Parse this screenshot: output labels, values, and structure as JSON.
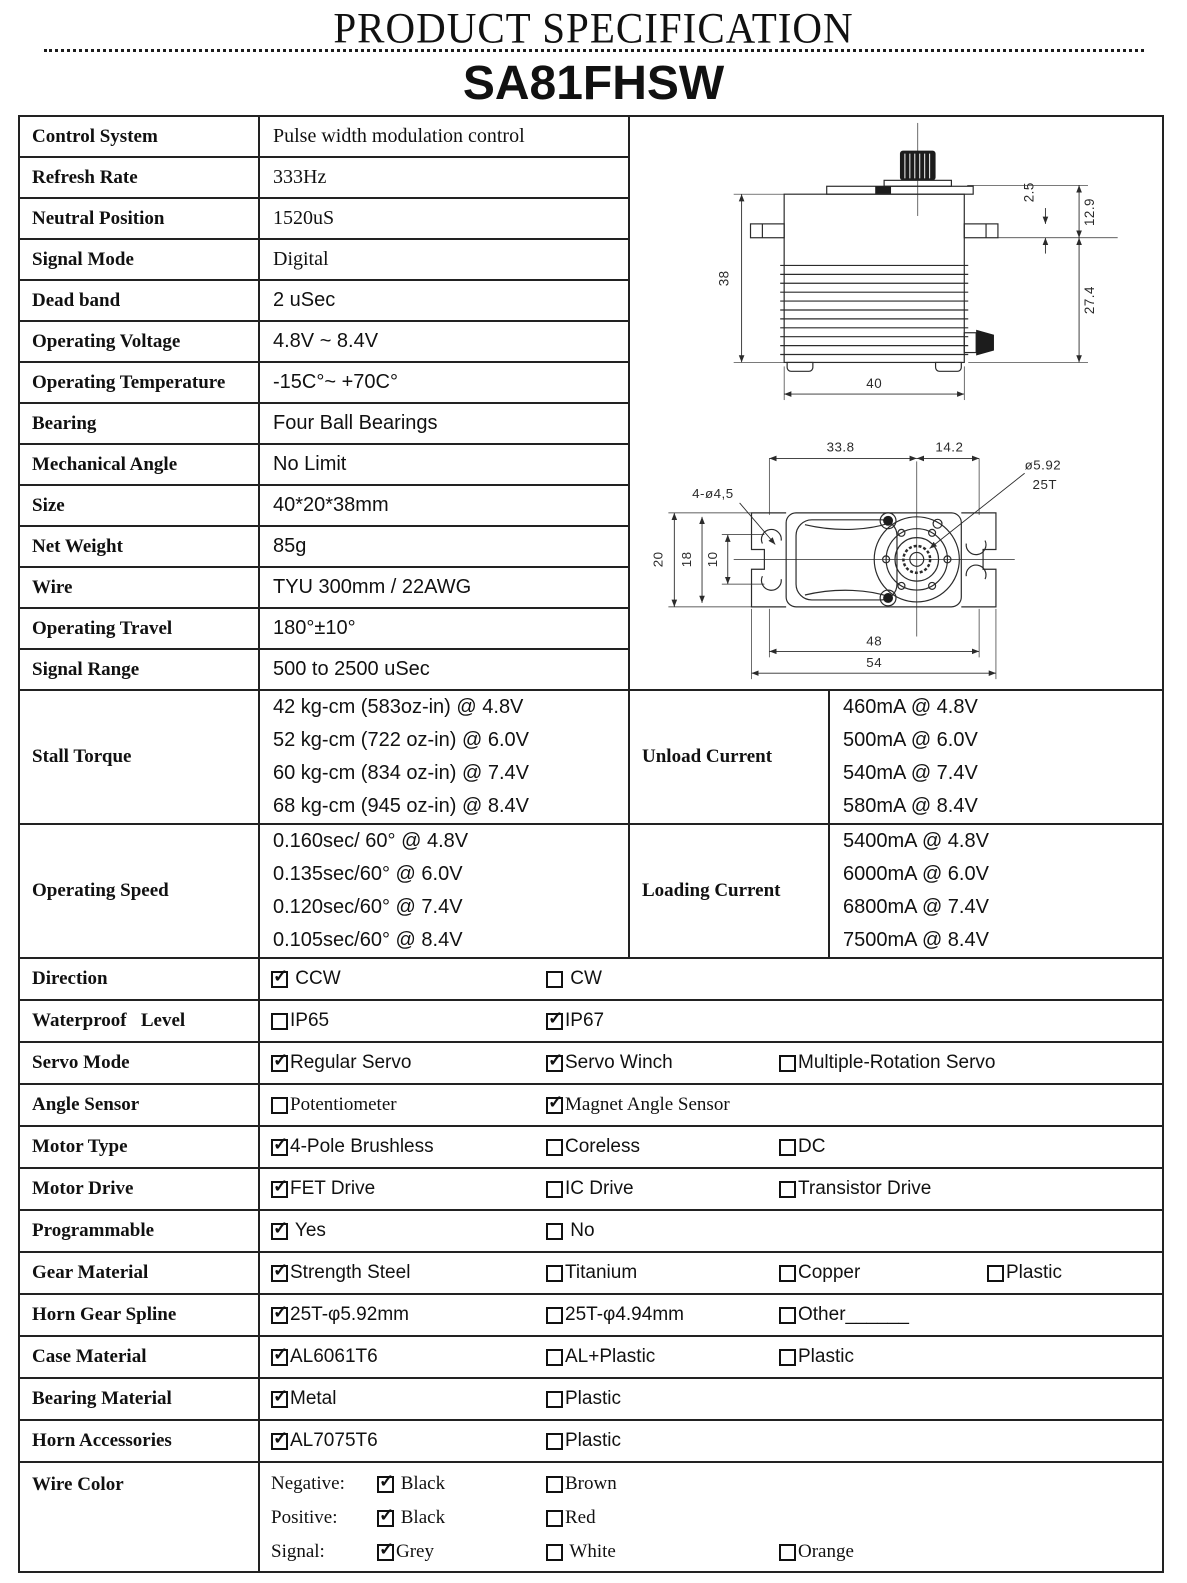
{
  "page": {
    "title": "PRODUCT SPECIFICATION",
    "model": "SA81FHSW"
  },
  "specs": [
    {
      "label": "Control System",
      "value": "Pulse width modulation control"
    },
    {
      "label": "Refresh Rate",
      "value": "333Hz"
    },
    {
      "label": "Neutral Position",
      "value": "1520uS"
    },
    {
      "label": "Signal Mode",
      "value": "Digital"
    },
    {
      "label": "Dead band",
      "value": "2 uSec"
    },
    {
      "label": "Operating Voltage",
      "value": "4.8V ~ 8.4V"
    },
    {
      "label": "Operating Temperature",
      "value": "-15C°~ +70C°"
    },
    {
      "label": "Bearing",
      "value": "Four Ball Bearings"
    },
    {
      "label": "Mechanical Angle",
      "value": "No Limit"
    },
    {
      "label": "Size",
      "value": "40*20*38mm"
    },
    {
      "label": "Net Weight",
      "value": "85g"
    },
    {
      "label": "Wire",
      "value": "TYU 300mm / 22AWG"
    },
    {
      "label": "Operating Travel",
      "value": "180°±10°"
    },
    {
      "label": "Signal Range",
      "value": "500 to 2500 uSec"
    }
  ],
  "torque_rows": [
    {
      "label": "Stall Torque",
      "values": [
        "42 kg-cm (583oz-in) @ 4.8V",
        "52 kg-cm (722 oz-in) @ 6.0V",
        "60 kg-cm (834 oz-in) @ 7.4V",
        "68 kg-cm (945 oz-in) @ 8.4V"
      ],
      "label2": "Unload Current",
      "values2": [
        "460mA @ 4.8V",
        "500mA @ 6.0V",
        "540mA @ 7.4V",
        "580mA @ 8.4V"
      ]
    },
    {
      "label": "Operating Speed",
      "values": [
        "0.160sec/ 60° @ 4.8V",
        "0.135sec/60° @ 6.0V",
        "0.120sec/60° @ 7.4V",
        "0.105sec/60° @ 8.4V"
      ],
      "label2": "Loading Current",
      "values2": [
        "5400mA @ 4.8V",
        "6000mA @ 6.0V",
        "6800mA @ 7.4V",
        "7500mA @ 8.4V"
      ]
    }
  ],
  "option_rows": [
    {
      "label": "Direction",
      "options": [
        {
          "label": " CCW",
          "checked": true
        },
        {
          "label": " CW",
          "checked": false
        }
      ]
    },
    {
      "label": "Waterproof   Level",
      "options": [
        {
          "label": "IP65",
          "checked": false
        },
        {
          "label": "IP67",
          "checked": true
        }
      ]
    },
    {
      "label": "Servo Mode",
      "options": [
        {
          "label": "Regular Servo",
          "checked": true
        },
        {
          "label": "Servo Winch",
          "checked": true
        },
        {
          "label": "Multiple-Rotation Servo",
          "checked": false
        }
      ]
    },
    {
      "label": "Angle Sensor",
      "options": [
        {
          "label": "Potentiometer",
          "checked": false
        },
        {
          "label": "Magnet Angle Sensor",
          "checked": true
        }
      ]
    },
    {
      "label": "Motor Type",
      "options": [
        {
          "label": "4-Pole Brushless",
          "checked": true
        },
        {
          "label": "Coreless",
          "checked": false
        },
        {
          "label": "DC",
          "checked": false
        }
      ]
    },
    {
      "label": "Motor Drive",
      "options": [
        {
          "label": "FET Drive",
          "checked": true
        },
        {
          "label": "IC Drive",
          "checked": false
        },
        {
          "label": "Transistor Drive",
          "checked": false
        }
      ]
    },
    {
      "label": "Programmable",
      "options": [
        {
          "label": " Yes",
          "checked": true
        },
        {
          "label": " No",
          "checked": false
        }
      ]
    },
    {
      "label": "Gear Material",
      "options": [
        {
          "label": "Strength Steel",
          "checked": true
        },
        {
          "label": "Titanium",
          "checked": false
        },
        {
          "label": "Copper",
          "checked": false
        },
        {
          "label": "Plastic",
          "checked": false
        }
      ]
    },
    {
      "label": "Horn Gear Spline",
      "options": [
        {
          "label": "25T-φ5.92mm",
          "checked": true
        },
        {
          "label": "25T-φ4.94mm",
          "checked": false
        },
        {
          "label": "Other______",
          "checked": false
        }
      ]
    },
    {
      "label": "Case Material",
      "options": [
        {
          "label": "AL6061T6",
          "checked": true
        },
        {
          "label": "AL+Plastic",
          "checked": false
        },
        {
          "label": "Plastic",
          "checked": false
        }
      ]
    },
    {
      "label": "Bearing Material",
      "options": [
        {
          "label": "Metal",
          "checked": true
        },
        {
          "label": "Plastic",
          "checked": false
        }
      ]
    },
    {
      "label": "Horn Accessories",
      "options": [
        {
          "label": "AL7075T6",
          "checked": true
        },
        {
          "label": "Plastic",
          "checked": false
        }
      ]
    }
  ],
  "wire_color": {
    "label": "Wire Color",
    "lines": [
      {
        "name": "Negative:",
        "options": [
          {
            "label": " Black",
            "checked": true
          },
          {
            "label": "Brown",
            "checked": false
          }
        ]
      },
      {
        "name": "Positive:",
        "options": [
          {
            "label": " Black",
            "checked": true
          },
          {
            "label": "Red",
            "checked": false
          }
        ]
      },
      {
        "name": "Signal:",
        "options": [
          {
            "label": "Grey",
            "checked": true
          },
          {
            "label": " White",
            "checked": false
          },
          {
            "label": "Orange",
            "checked": false
          }
        ]
      }
    ]
  },
  "drawings": {
    "side": {
      "height": "38",
      "cap": "2.5",
      "upper": "12.9",
      "lower": "27.4",
      "width": "40"
    },
    "top": {
      "left": "33.8",
      "right": "14.2",
      "spline_dia": "ø5.92",
      "spline_teeth": "25T",
      "holes": "4-ø4,5",
      "w20": "20",
      "w18": "18",
      "w10": "10",
      "span48": "48",
      "span54": "54"
    }
  }
}
